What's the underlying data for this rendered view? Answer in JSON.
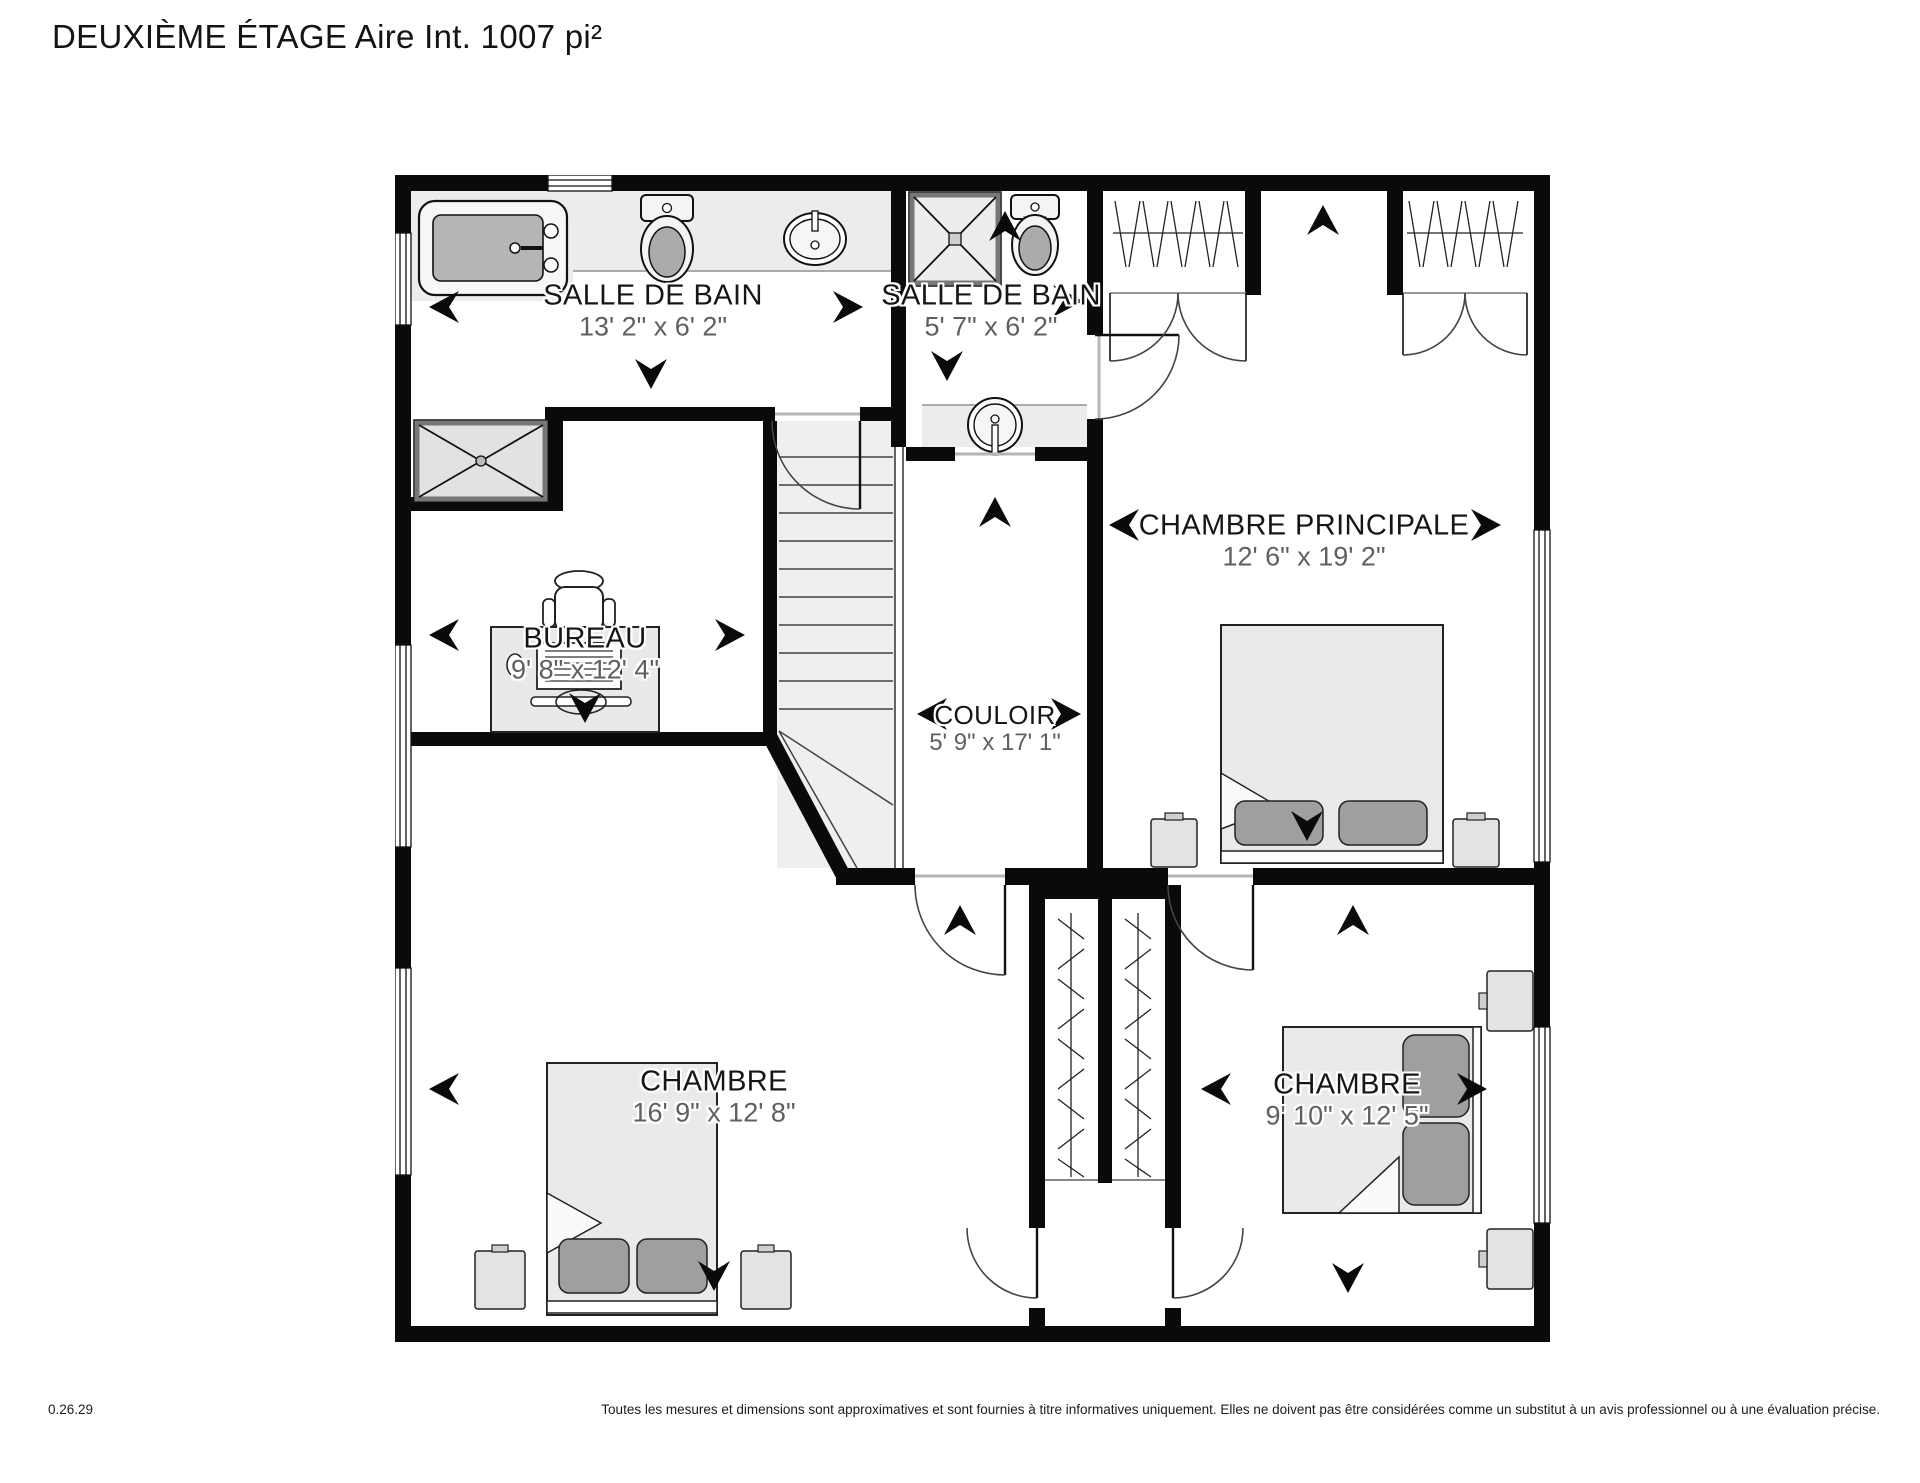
{
  "title": "DEUXIÈME ÉTAGE Aire Int. 1007 pi²",
  "rooms": [
    {
      "id": "salle-de-bain-1",
      "name": "SALLE DE BAIN",
      "dims": "13' 2\" x 6' 2\""
    },
    {
      "id": "salle-de-bain-2",
      "name": "SALLE DE BAIN",
      "dims": "5' 7\" x 6' 2\""
    },
    {
      "id": "chambre-principale",
      "name": "CHAMBRE PRINCIPALE",
      "dims": "12' 6\" x 19' 2\""
    },
    {
      "id": "bureau",
      "name": "BUREAU",
      "dims": "9' 8\" x 12' 4\""
    },
    {
      "id": "couloir",
      "name": "COULOIR",
      "dims": "5' 9\" x 17' 1\""
    },
    {
      "id": "chambre-2",
      "name": "CHAMBRE",
      "dims": "16' 9\" x 12' 8\""
    },
    {
      "id": "chambre-3",
      "name": "CHAMBRE",
      "dims": "9' 10\" x 12' 5\""
    }
  ],
  "footer": {
    "version": "0.26.29",
    "disclaimer": "Toutes les mesures et dimensions sont approximatives et sont fournies à titre informatives uniquement. Elles ne doivent pas être considérées comme un substitut à un avis professionnel ou à une évaluation précise."
  },
  "colors": {
    "wall": "#0a0a0a",
    "fixture": "#ededed",
    "pillow": "#9f9f9f",
    "dims_text": "#5f5f5f"
  }
}
